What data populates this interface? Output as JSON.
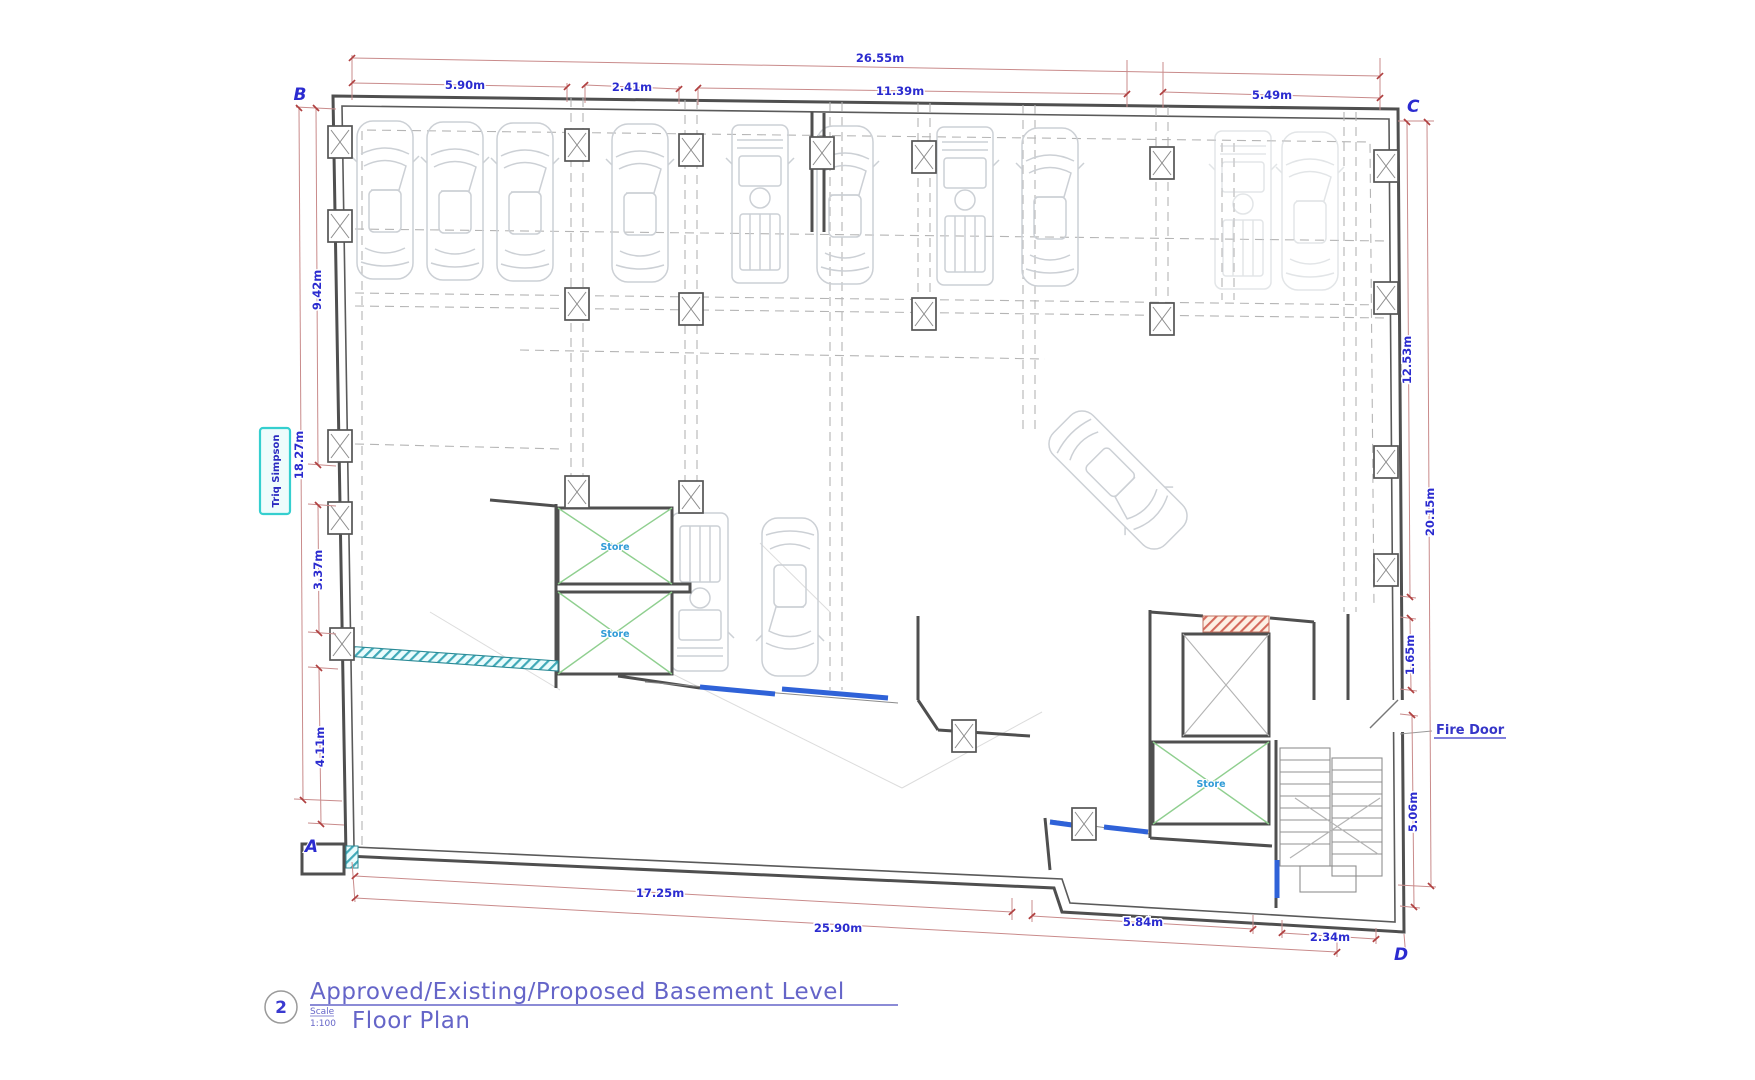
{
  "drawing": {
    "corner_labels": {
      "top_left": "B",
      "top_right": "C",
      "bottom_left": "A",
      "bottom_right": "D"
    },
    "street_label": "Triq Simpson",
    "fire_door_label": "Fire Door",
    "store_label": "Store",
    "dims": {
      "top_overall": "26.55m",
      "top_a": "5.90m",
      "top_b": "2.41m",
      "top_c": "11.39m",
      "top_d": "5.49m",
      "left_a": "9.42m",
      "left_overall": "18.27m",
      "left_b": "3.37m",
      "left_c": "4.11m",
      "right_a": "12.53m",
      "right_overall": "20.15m",
      "right_b": "1.65m",
      "right_c": "5.06m",
      "bottom_a": "17.25m",
      "bottom_overall": "25.90m",
      "bottom_b": "5.84m",
      "bottom_c": "2.34m"
    },
    "title_block": {
      "number": "2",
      "line1": "Approved/Existing/Proposed Basement Level",
      "line2": "Floor Plan",
      "scale_label": "Scale",
      "scale_value": "1:100"
    },
    "colors": {
      "wall": "#4f4f4f",
      "dimension_line": "#c98b8b",
      "dimension_text": "#2b2bcf",
      "car_outline": "#ccd0d5",
      "store_x_green": "#8fcf8f",
      "store_text": "#2f9bd6",
      "highlight_wall_blue": "#2f62d8",
      "street_box_cyan": "#35cfcf",
      "hatch_cyan": "#3fa9b8",
      "hatch_red": "#d4695c",
      "title_text": "#6565c8"
    }
  }
}
